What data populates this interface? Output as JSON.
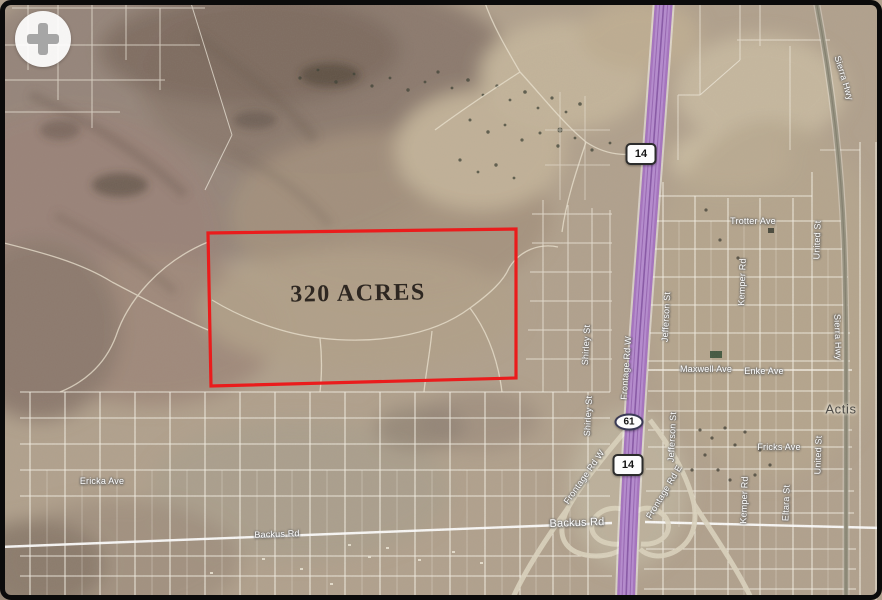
{
  "parcel": {
    "acreage_label": "320 ACRES",
    "outline_color": "#ea1c1c"
  },
  "shields": {
    "route_14": "14",
    "exit_61": "61"
  },
  "roads": {
    "backus_rd": "Backus Rd",
    "sierra_hwy": "Sierra Hwy",
    "shirley_st": "Shirley St",
    "frontage_rd_w": "Frontage Rd W",
    "frontage_rd_e": "Frontage Rd E",
    "jefferson_st": "Jefferson St",
    "trotter_ave": "Trotter Ave",
    "united_st": "United St",
    "kemper_rd": "Kemper Rd",
    "maxwell_ave": "Maxwell Ave",
    "enke_ave": "Enke Ave",
    "fricks_ave": "Fricks Ave",
    "ericka_ave": "Ericka Ave",
    "eltara_st": "Eltara St"
  },
  "places": {
    "actis": "Actis"
  },
  "controls": {
    "zoom_in": "+"
  },
  "colors": {
    "highway_purple": "#a673c1",
    "terrain_base": "#b2a28e",
    "parcel_outline": "#ea1c1c",
    "road_line": "#f8f4ea"
  }
}
